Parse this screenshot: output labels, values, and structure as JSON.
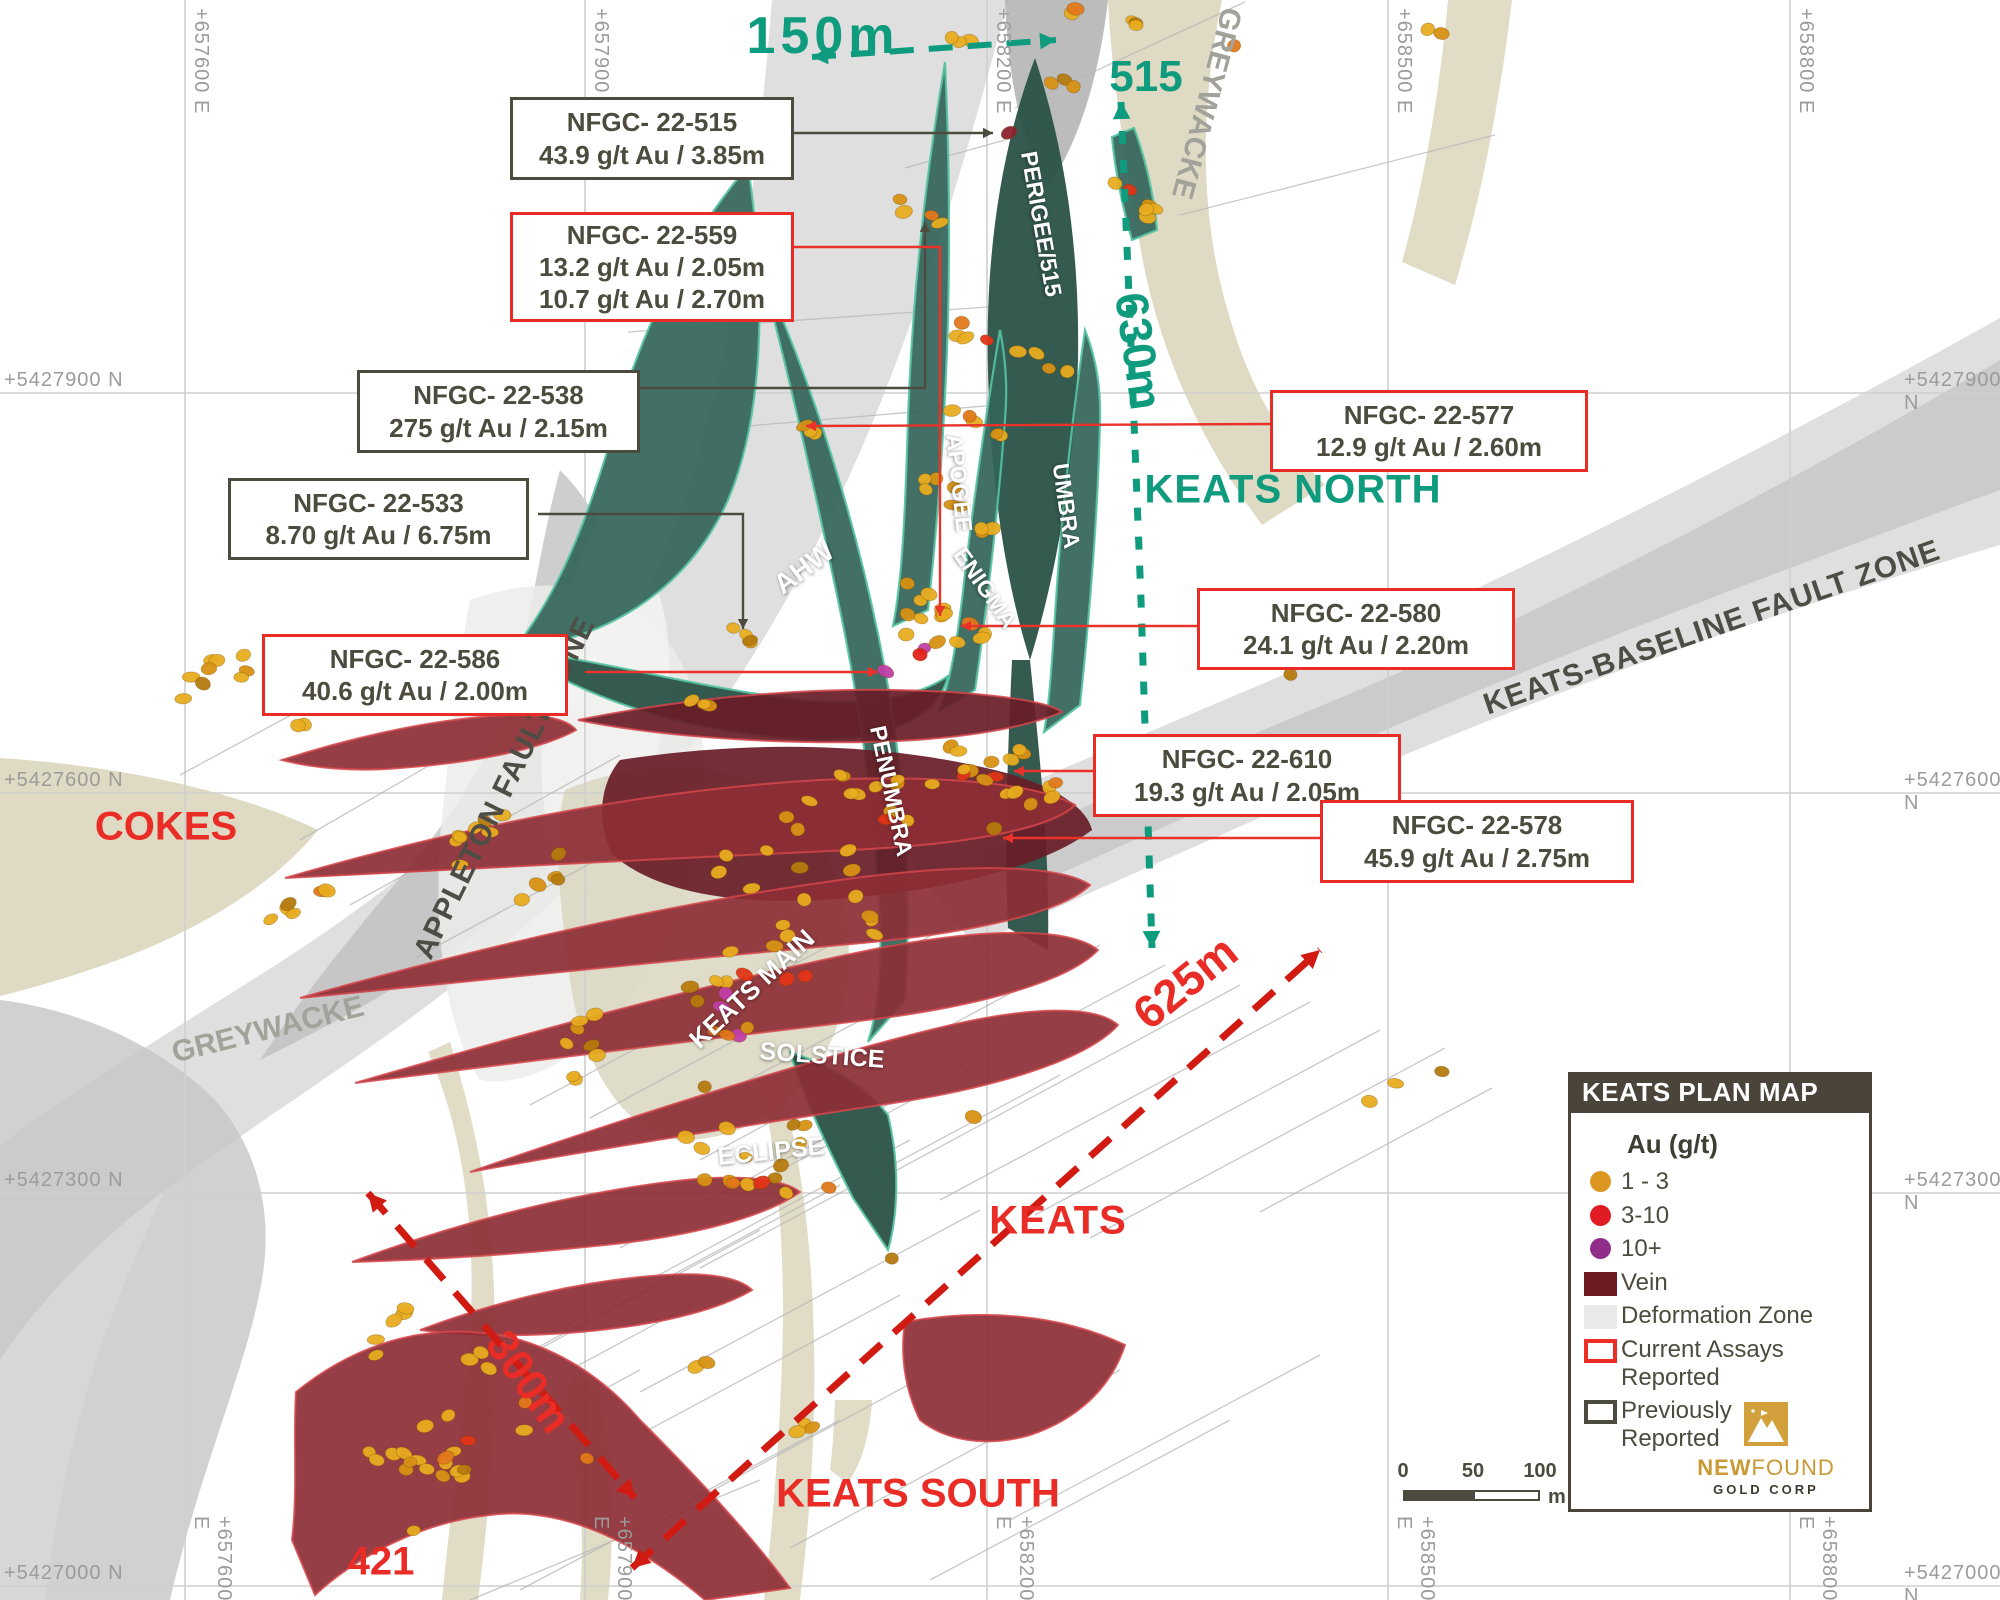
{
  "map": {
    "title": "KEATS PLAN MAP",
    "width": 2000,
    "height": 1600,
    "palette": {
      "teal": "#0f9b7e",
      "red": "#ea2c26",
      "dark": "#4c4b3d",
      "rock": "#a2a29b",
      "fault": "#4d4d45",
      "gridline": "#cfcfcf",
      "gridtext": "#9b9b99",
      "trace": "#b5b5b5",
      "veinTeal": "#35655a",
      "veinTealDark": "#2a5247",
      "veinTealEdge": "#55c3a2",
      "maroon": "#8c2e35",
      "maroonDark": "#681c26",
      "maroonEdge": "#d4464b",
      "beige": "#ddd8c0",
      "defGray": "#d2d2d2"
    }
  },
  "grid": {
    "east": [
      {
        "label": "+657600 E",
        "x": 185
      },
      {
        "label": "+657900 E",
        "x": 585
      },
      {
        "label": "+658200 E",
        "x": 987
      },
      {
        "label": "+658500 E",
        "x": 1388
      },
      {
        "label": "+658800 E",
        "x": 1790
      }
    ],
    "north": [
      {
        "label": "+5427900 N",
        "y": 393
      },
      {
        "label": "+5427600 N",
        "y": 793
      },
      {
        "label": "+5427300 N",
        "y": 1193
      },
      {
        "label": "+5427000 N",
        "y": 1586
      }
    ]
  },
  "callouts": [
    {
      "id": "nfgc-22-515",
      "x": 510,
      "y": 97,
      "w": 278,
      "h": 77,
      "style": "previous",
      "lines": [
        "NFGC- 22-515",
        "43.9 g/t Au / 3.85m"
      ]
    },
    {
      "id": "nfgc-22-559",
      "x": 510,
      "y": 212,
      "w": 278,
      "h": 104,
      "style": "current",
      "lines": [
        "NFGC- 22-559",
        "13.2 g/t Au / 2.05m",
        "10.7 g/t Au / 2.70m"
      ]
    },
    {
      "id": "nfgc-22-538",
      "x": 357,
      "y": 370,
      "w": 277,
      "h": 77,
      "style": "previous",
      "lines": [
        "NFGC- 22-538",
        "275 g/t Au / 2.15m"
      ]
    },
    {
      "id": "nfgc-22-533",
      "x": 228,
      "y": 478,
      "w": 295,
      "h": 76,
      "style": "previous",
      "lines": [
        "NFGC- 22-533",
        "8.70 g/t Au / 6.75m"
      ]
    },
    {
      "id": "nfgc-22-586",
      "x": 262,
      "y": 634,
      "w": 300,
      "h": 76,
      "style": "current",
      "lines": [
        "NFGC- 22-586",
        "40.6 g/t Au / 2.00m"
      ]
    },
    {
      "id": "nfgc-22-577",
      "x": 1270,
      "y": 390,
      "w": 312,
      "h": 76,
      "style": "current",
      "lines": [
        "NFGC- 22-577",
        "12.9 g/t Au / 2.60m"
      ]
    },
    {
      "id": "nfgc-22-580",
      "x": 1197,
      "y": 588,
      "w": 312,
      "h": 76,
      "style": "current",
      "lines": [
        "NFGC- 22-580",
        "24.1 g/t Au / 2.20m"
      ]
    },
    {
      "id": "nfgc-22-610",
      "x": 1093,
      "y": 734,
      "w": 302,
      "h": 77,
      "style": "current",
      "lines": [
        "NFGC- 22-610",
        "19.3 g/t Au / 2.05m"
      ]
    },
    {
      "id": "nfgc-22-578",
      "x": 1320,
      "y": 800,
      "w": 308,
      "h": 77,
      "style": "current",
      "lines": [
        "NFGC- 22-578",
        "45.9 g/t Au / 2.75m"
      ]
    }
  ],
  "connectors": [
    {
      "c": "dark",
      "pts": [
        [
          788,
          133
        ],
        [
          993,
          133
        ]
      ]
    },
    {
      "c": "dark",
      "pts": [
        [
          633,
          388
        ],
        [
          925,
          388
        ],
        [
          925,
          222
        ]
      ]
    },
    {
      "c": "dark",
      "pts": [
        [
          538,
          514
        ],
        [
          743,
          514
        ],
        [
          743,
          629
        ]
      ]
    },
    {
      "c": "red",
      "pts": [
        [
          787,
          247
        ],
        [
          940,
          247
        ],
        [
          940,
          616
        ]
      ]
    },
    {
      "c": "red",
      "pts": [
        [
          585,
          672
        ],
        [
          878,
          672
        ]
      ]
    },
    {
      "c": "red",
      "pts": [
        [
          1270,
          424
        ],
        [
          806,
          426
        ]
      ]
    },
    {
      "c": "red",
      "pts": [
        [
          1197,
          626
        ],
        [
          961,
          626
        ]
      ]
    },
    {
      "c": "red",
      "pts": [
        [
          1093,
          771
        ],
        [
          1014,
          771
        ]
      ]
    },
    {
      "c": "red",
      "pts": [
        [
          1320,
          838
        ],
        [
          1003,
          838
        ]
      ]
    }
  ],
  "arrows": [
    {
      "id": "arrow-150m",
      "c": "teal",
      "w": 6,
      "dash": "24 15",
      "hs": 16,
      "pts": [
        [
          812,
          57
        ],
        [
          1056,
          40
        ]
      ]
    },
    {
      "id": "arrow-630m",
      "c": "teal",
      "w": 7,
      "dash": "13 16",
      "hs": 17,
      "pts": [
        [
          1121,
          102
        ],
        [
          1130,
          320
        ],
        [
          1141,
          600
        ],
        [
          1152,
          948
        ]
      ]
    },
    {
      "id": "arrow-625m",
      "c": "red",
      "w": 7,
      "dash": "27 17",
      "hs": 18,
      "pts": [
        [
          632,
          1568
        ],
        [
          1320,
          950
        ]
      ]
    },
    {
      "id": "arrow-300m",
      "c": "red",
      "w": 7,
      "dash": "27 17",
      "hs": 18,
      "pts": [
        [
          368,
          1193
        ],
        [
          635,
          1498
        ]
      ]
    }
  ],
  "labels": [
    {
      "id": "dist-150m",
      "t": "150m",
      "x": 823,
      "y": 36,
      "r": 0,
      "s": 52,
      "cls": "teal",
      "ls": 5
    },
    {
      "id": "area-515",
      "t": "515",
      "x": 1146,
      "y": 77,
      "r": 0,
      "s": 44,
      "cls": "teal"
    },
    {
      "id": "dist-630m",
      "t": "630m",
      "x": 1139,
      "y": 351,
      "r": 82,
      "s": 46,
      "cls": "teal"
    },
    {
      "id": "area-keats-north",
      "t": "KEATS NORTH",
      "x": 1293,
      "y": 490,
      "r": 0,
      "s": 40,
      "cls": "teal",
      "ls": 1
    },
    {
      "id": "area-cokes",
      "t": "COKES",
      "x": 166,
      "y": 827,
      "r": 0,
      "s": 40,
      "cls": "red"
    },
    {
      "id": "area-keats",
      "t": "KEATS",
      "x": 1058,
      "y": 1221,
      "r": 0,
      "s": 40,
      "cls": "red",
      "ls": 1
    },
    {
      "id": "dist-625m",
      "t": "625m",
      "x": 1185,
      "y": 982,
      "r": -39,
      "s": 46,
      "cls": "red"
    },
    {
      "id": "dist-300m",
      "t": "300m",
      "x": 528,
      "y": 1382,
      "r": 55,
      "s": 44,
      "cls": "red"
    },
    {
      "id": "area-keats-south",
      "t": "KEATS SOUTH",
      "x": 918,
      "y": 1494,
      "r": 0,
      "s": 40,
      "cls": "red"
    },
    {
      "id": "area-421",
      "t": "421",
      "x": 381,
      "y": 1562,
      "r": 0,
      "s": 40,
      "cls": "red"
    },
    {
      "id": "vein-perigee-515",
      "t": "PERIGEE/515",
      "x": 1041,
      "y": 224,
      "r": 80,
      "s": 23,
      "cls": "vein"
    },
    {
      "id": "vein-apogee",
      "t": "APOGEE",
      "x": 959,
      "y": 483,
      "r": 84,
      "s": 23,
      "cls": "vein"
    },
    {
      "id": "vein-enigma",
      "t": "ENIGMA",
      "x": 985,
      "y": 588,
      "r": 55,
      "s": 23,
      "cls": "vein"
    },
    {
      "id": "vein-umbra",
      "t": "UMBRA",
      "x": 1066,
      "y": 506,
      "r": 82,
      "s": 23,
      "cls": "vein"
    },
    {
      "id": "vein-ahw",
      "t": "AHW",
      "x": 804,
      "y": 568,
      "r": -37,
      "s": 28,
      "cls": "vein"
    },
    {
      "id": "vein-penumbra",
      "t": "PENUMBRA",
      "x": 891,
      "y": 791,
      "r": 78,
      "s": 23,
      "cls": "vein"
    },
    {
      "id": "vein-keats-main",
      "t": "KEATS MAIN",
      "x": 752,
      "y": 989,
      "r": -43,
      "s": 26,
      "cls": "vein"
    },
    {
      "id": "vein-solstice",
      "t": "SOLSTICE",
      "x": 822,
      "y": 1056,
      "r": 4,
      "s": 25,
      "cls": "vein"
    },
    {
      "id": "vein-eclipse",
      "t": "ECLIPSE",
      "x": 771,
      "y": 1152,
      "r": -6,
      "s": 25,
      "cls": "vein"
    },
    {
      "id": "rock-greywacke-ne",
      "t": "GREYWACKE",
      "x": 1206,
      "y": 103,
      "r": 105,
      "s": 30,
      "cls": "rock"
    },
    {
      "id": "rock-greywacke-sw",
      "t": "GREYWACKE",
      "x": 268,
      "y": 1030,
      "r": -14,
      "s": 30,
      "cls": "rock"
    },
    {
      "id": "fault-appleton",
      "t": "APPLETON FAULT ZONE",
      "x": 505,
      "y": 788,
      "r": -64,
      "s": 30,
      "cls": "fault"
    },
    {
      "id": "fault-keats-baseline",
      "t": "KEATS-BASELINE FAULT ZONE",
      "x": 1712,
      "y": 628,
      "r": -19,
      "s": 30,
      "cls": "fault"
    }
  ],
  "legend": {
    "title": "KEATS PLAN MAP",
    "au_header": "Au (g/t)",
    "items": [
      {
        "swatch": "dot",
        "color": "#dc9722",
        "lines": [
          "1 - 3"
        ]
      },
      {
        "swatch": "dot",
        "color": "#e11b23",
        "lines": [
          "3-10"
        ]
      },
      {
        "swatch": "dot",
        "color": "#8f2d89",
        "lines": [
          "10+"
        ]
      },
      {
        "swatch": "rect",
        "color": "#6d1a23",
        "lines": [
          "Vein"
        ]
      },
      {
        "swatch": "rect",
        "color": "#e9e9e7",
        "lines": [
          "Deformation Zone"
        ]
      },
      {
        "swatch": "outline",
        "color": "#ee2e24",
        "lines": [
          "Current Assays",
          "Reported"
        ]
      },
      {
        "swatch": "outline",
        "color": "#4c4b3d",
        "lines": [
          "Previously",
          "Reported"
        ]
      }
    ],
    "logo": {
      "bold": "NEW",
      "rest": "FOUND",
      "sub": "GOLD CORP"
    }
  },
  "scalebar": {
    "ticks": [
      "0",
      "50",
      "100"
    ],
    "unit": "m"
  },
  "dots": {
    "seed": 20221215,
    "palettes": {
      "gold": [
        [
          "#e8ac20",
          55
        ],
        [
          "#d79114",
          20
        ],
        [
          "#b57a0e",
          10
        ],
        [
          "#e2781b",
          15
        ]
      ],
      "hot": [
        [
          "#e8ac20",
          40
        ],
        [
          "#e2781b",
          25
        ],
        [
          "#e03418",
          20
        ],
        [
          "#d79114",
          15
        ]
      ],
      "mixed": [
        [
          "#e8ac20",
          50
        ],
        [
          "#d79114",
          15
        ],
        [
          "#b57a0e",
          8
        ],
        [
          "#e2781b",
          12
        ],
        [
          "#e03418",
          9
        ],
        [
          "#c13ea6",
          6
        ]
      ],
      "purple": [
        [
          "#c13ea6",
          100
        ]
      ],
      "red1": [
        [
          "#e02318",
          100
        ]
      ],
      "vein": [
        [
          "#8c2430",
          100
        ]
      ]
    },
    "clusters": [
      [
        1105,
        14,
        5,
        45,
        9,
        12,
        "gold"
      ],
      [
        1056,
        83,
        3,
        22,
        7,
        15,
        "gold"
      ],
      [
        1237,
        46,
        1,
        3,
        3,
        0,
        "gold"
      ],
      [
        1432,
        28,
        2,
        12,
        5,
        15,
        "gold"
      ],
      [
        1130,
        196,
        6,
        40,
        10,
        38,
        "hot"
      ],
      [
        963,
        42,
        3,
        16,
        6,
        20,
        "gold"
      ],
      [
        1008,
        134,
        1,
        2,
        2,
        0,
        "vein"
      ],
      [
        920,
        213,
        4,
        26,
        8,
        30,
        "gold"
      ],
      [
        1010,
        350,
        8,
        62,
        9,
        22,
        "hot"
      ],
      [
        975,
        422,
        5,
        30,
        10,
        30,
        "gold"
      ],
      [
        806,
        427,
        3,
        15,
        6,
        20,
        "hot"
      ],
      [
        957,
        505,
        9,
        45,
        14,
        40,
        "gold"
      ],
      [
        930,
        622,
        16,
        55,
        28,
        35,
        "mixed"
      ],
      [
        886,
        672,
        1,
        2,
        2,
        0,
        "purple"
      ],
      [
        920,
        655,
        1,
        2,
        2,
        0,
        "red1"
      ],
      [
        748,
        641,
        4,
        22,
        8,
        30,
        "gold"
      ],
      [
        700,
        700,
        3,
        18,
        6,
        30,
        "gold"
      ],
      [
        812,
        830,
        16,
        110,
        38,
        -35,
        "gold"
      ],
      [
        780,
        962,
        24,
        125,
        48,
        -40,
        "mixed"
      ],
      [
        952,
        790,
        14,
        80,
        40,
        -40,
        "hot"
      ],
      [
        1022,
        800,
        7,
        42,
        18,
        -30,
        "gold"
      ],
      [
        1293,
        672,
        1,
        3,
        3,
        0,
        "gold"
      ],
      [
        973,
        1117,
        1,
        3,
        3,
        0,
        "gold"
      ],
      [
        890,
        1258,
        1,
        3,
        3,
        0,
        "gold"
      ],
      [
        1400,
        1085,
        3,
        52,
        8,
        -25,
        "gold"
      ],
      [
        213,
        677,
        9,
        50,
        18,
        -30,
        "gold"
      ],
      [
        300,
        722,
        2,
        12,
        5,
        0,
        "gold"
      ],
      [
        480,
        842,
        8,
        60,
        18,
        -35,
        "gold"
      ],
      [
        295,
        905,
        6,
        42,
        14,
        -35,
        "gold"
      ],
      [
        540,
        880,
        5,
        40,
        12,
        -35,
        "gold"
      ],
      [
        735,
        1150,
        16,
        55,
        80,
        -65,
        "mixed"
      ],
      [
        585,
        1040,
        8,
        50,
        25,
        -45,
        "gold"
      ],
      [
        450,
        1440,
        24,
        88,
        55,
        -40,
        "mixed"
      ],
      [
        390,
        1330,
        5,
        35,
        12,
        -40,
        "gold"
      ],
      [
        705,
        1365,
        2,
        10,
        5,
        0,
        "gold"
      ],
      [
        810,
        1422,
        3,
        25,
        8,
        -30,
        "gold"
      ],
      [
        586,
        1456,
        1,
        3,
        3,
        0,
        "gold"
      ],
      [
        830,
        1190,
        1,
        3,
        3,
        0,
        "gold"
      ]
    ]
  },
  "traces": [
    [
      1445,
      1048,
      1090,
      1238
    ],
    [
      1492,
      1088,
      1260,
      1212
    ],
    [
      1380,
      1030,
      1035,
      1215
    ],
    [
      1310,
      1002,
      940,
      1200
    ],
    [
      1240,
      985,
      860,
      1190
    ],
    [
      1165,
      965,
      785,
      1168
    ],
    [
      1100,
      945,
      700,
      1160
    ],
    [
      1030,
      930,
      645,
      1135
    ],
    [
      960,
      920,
      590,
      1118
    ],
    [
      900,
      908,
      530,
      1105
    ],
    [
      980,
      1055,
      620,
      1248
    ],
    [
      1060,
      1075,
      700,
      1268
    ],
    [
      910,
      1140,
      560,
      1328
    ],
    [
      840,
      1185,
      490,
      1373
    ],
    [
      980,
      1210,
      640,
      1392
    ],
    [
      900,
      1295,
      570,
      1472
    ],
    [
      1010,
      1330,
      680,
      1508
    ],
    [
      1120,
      1370,
      790,
      1548
    ],
    [
      760,
      1230,
      430,
      1408
    ],
    [
      700,
      1300,
      380,
      1472
    ],
    [
      640,
      1370,
      330,
      1536
    ],
    [
      840,
      1420,
      520,
      1590
    ],
    [
      760,
      1480,
      470,
      1600
    ],
    [
      1230,
      1420,
      930,
      1580
    ],
    [
      1320,
      1355,
      1010,
      1520
    ],
    [
      1060,
      302,
      628,
      332
    ],
    [
      1080,
      398,
      700,
      430
    ],
    [
      1245,
      2,
      1015,
      108
    ],
    [
      1495,
      135,
      1180,
      215
    ],
    [
      430,
      640,
      180,
      775
    ],
    [
      560,
      690,
      300,
      840
    ],
    [
      620,
      755,
      350,
      905
    ],
    [
      680,
      815,
      415,
      958
    ],
    [
      905,
      168,
      1005,
      140
    ]
  ]
}
